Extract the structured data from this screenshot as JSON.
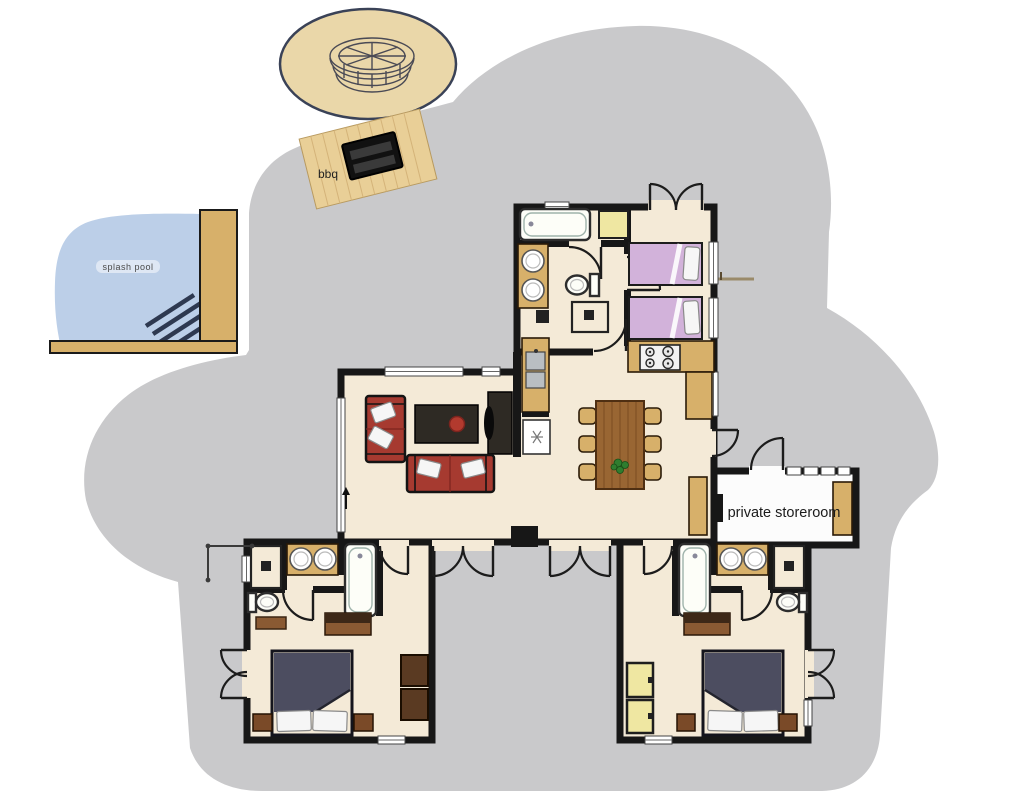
{
  "floorplan": {
    "labels": {
      "bbq": "bbq",
      "splash_pool": "splash pool",
      "private_storeroom": "private storeroom"
    },
    "colors": {
      "terrace": "#c9c9cb",
      "floor": "#f4ead7",
      "wall": "#171717",
      "wood": "#d7b06a",
      "wood_dark": "#8a5a33",
      "pool": "#bccfe8",
      "sand": "#ead7a9",
      "deck_bbq": "#e9cf97",
      "bed_lavender": "#d2b2da",
      "bed_navy": "#4c4d60",
      "sofa_red": "#a63a30",
      "espresso": "#2e2a24",
      "cabinet_yellow": "#efe7a2",
      "storeroom_floor": "#fcfcfc",
      "chair_brown": "#5a3a22"
    }
  }
}
